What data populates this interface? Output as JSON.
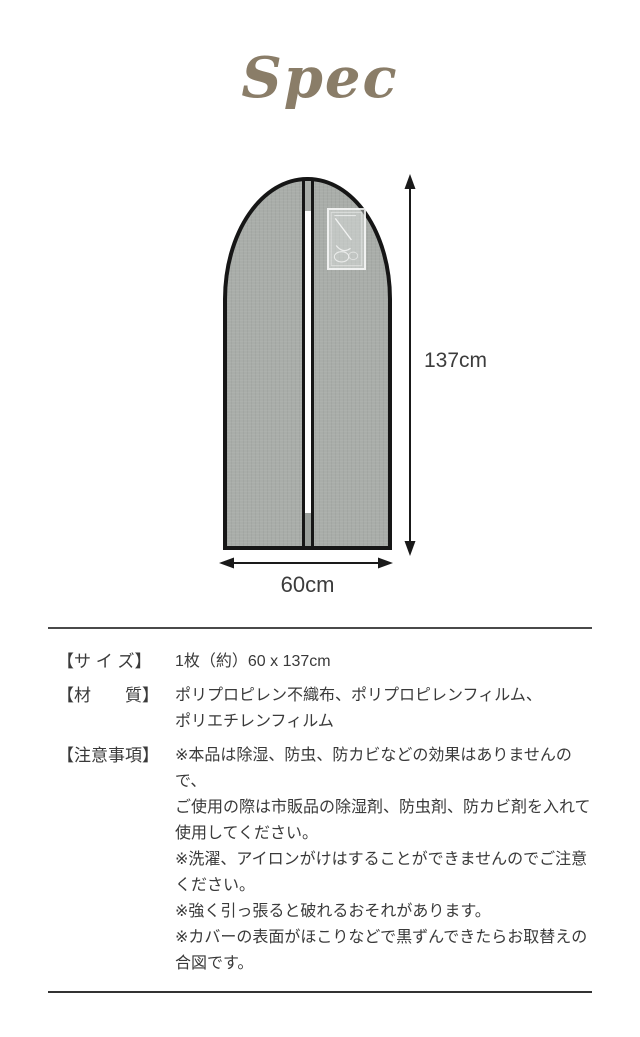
{
  "page": {
    "title": "Spec"
  },
  "diagram": {
    "height_label": "137cm",
    "width_label": "60cm"
  },
  "specs": {
    "rows": [
      {
        "label": "【サ イ ズ】",
        "value": "1枚（約）60 x 137cm"
      },
      {
        "label": "【材　　質】",
        "value": [
          "ポリプロピレン不織布、ポリプロピレンフィルム、",
          "ポリエチレンフィルム"
        ]
      },
      {
        "label": "【注意事項】",
        "value": [
          "※本品は除湿、防虫、防カビなどの効果はありませんので、",
          "ご使用の際は市販品の除湿剤、防虫剤、防カビ剤を入れて",
          "使用してください。",
          "※洗濯、アイロンがけはすることができませんのでご注意",
          "ください。",
          "※強く引っ張ると破れるおそれがあります。",
          "※カバーの表面がほこりなどで黒ずんできたらお取替えの",
          "合図です。"
        ]
      }
    ]
  },
  "colors": {
    "title_accent": "#8a7d68",
    "bag_fill": "#a9ada9",
    "bag_outline": "#161616",
    "body_text": "#3a3a3a"
  }
}
